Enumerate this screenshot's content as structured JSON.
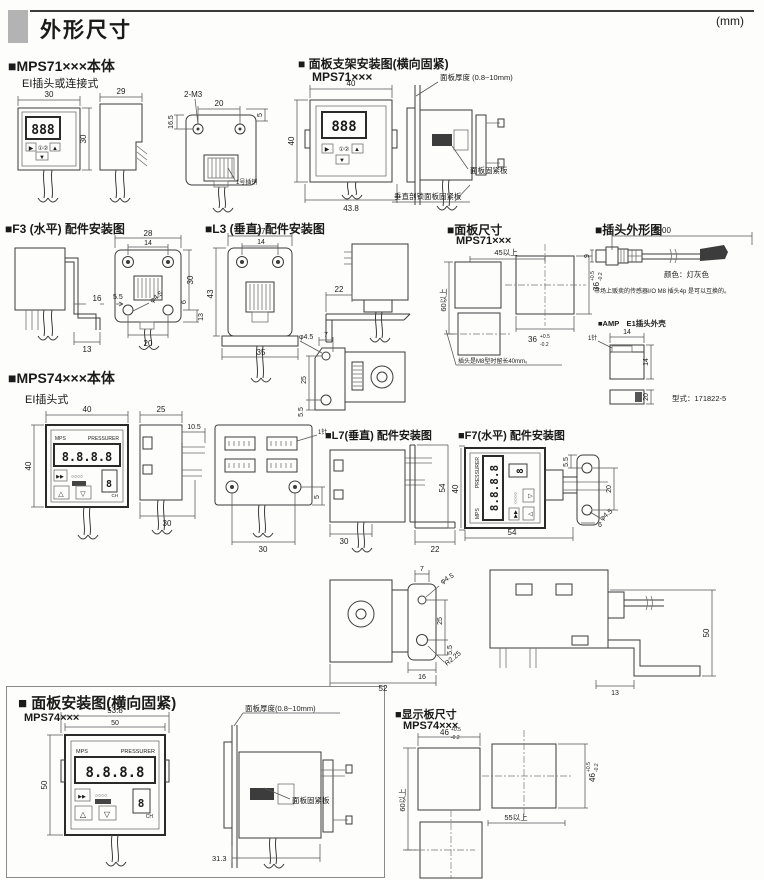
{
  "header": {
    "title": "外形尺寸",
    "unit": "(mm)"
  },
  "mps71": {
    "title": "■MPS71×××本体",
    "subtitle": "EI插头或连接式",
    "display": "888",
    "btn_right": "▶",
    "btn_up": "▲",
    "btn_down": "▼",
    "leds": "①②",
    "dim_front_w": "30",
    "dim_front_h": "30",
    "dim_side_w": "29",
    "screw": "2-M3",
    "dim_pitch": "20",
    "dim_h": "16.5",
    "dim_offset": "5",
    "pin_label": "1号插销"
  },
  "bracket71": {
    "title": "■ 面板支架安装图(横向固紧)",
    "model": "MPS71×××",
    "display": "888",
    "btn_right": "▶",
    "btn_up": "▲",
    "btn_down": "▼",
    "leds": "①②",
    "dim_w": "40",
    "dim_h": "40",
    "dim_bw": "43.8",
    "thickness": "面板厚度 (0.8~10mm)",
    "plate": "面板固紧板",
    "note": "垂直剖锁面板固紧板"
  },
  "f3": {
    "title": "■F3 (水平) 配件安装图",
    "d28": "28",
    "d14": "14",
    "d30": "30",
    "d16": "16",
    "d13a": "13",
    "d13b": "13",
    "d55": "5.5",
    "d20": "20",
    "d6": "6",
    "dphi": "φ4.5"
  },
  "l3": {
    "title": "■L3 (垂直) 配件安装图",
    "d27": "27",
    "d14": "14",
    "d43": "43",
    "d35": "35",
    "d22": "22",
    "d7": "7",
    "dphi": "φ4.5",
    "d25": "25",
    "d55": "5.5"
  },
  "panel71": {
    "title": "■面板尺寸",
    "model": "MPS71×××",
    "d45": "45以上",
    "d36": "36",
    "tol_p": "+0.5",
    "tol_m": "-0.2",
    "d60": "60以上",
    "note": "插头是M8型时留长40mm。"
  },
  "plug": {
    "title": "■插头外形图",
    "d2000": "2000",
    "d9": "9",
    "color": "颜色：灯灰色",
    "note": "市场上贩卖的传感器I/O M8 插头4p 是可以互换的。",
    "amp_title": "■AMP　E1插头外壳",
    "pin": "1针",
    "d14a": "14",
    "d14b": "14",
    "d20": "20",
    "model": "型式：171822-5"
  },
  "mps74": {
    "title": "■MPS74×××本体",
    "subtitle": "EI插头式",
    "brand": "MPS",
    "brand2": "PRESSURER",
    "display": "8.8.8.8",
    "ch_digit": "8",
    "ch": "CH",
    "btn_ff": "▶▶",
    "leds": "○○○○",
    "btn_up": "△",
    "btn_down": "▽",
    "dim_w": "40",
    "dim_h": "40",
    "dim_side": "25",
    "dim_tab": "10.5",
    "dim_side_b": "30",
    "pin": "1针",
    "dim_5": "5",
    "dim_back_b": "30"
  },
  "l7": {
    "title": "■L7(垂直) 配件安装图",
    "d30": "30",
    "d22": "22",
    "d54": "54"
  },
  "f7": {
    "title": "■F7(水平) 配件安装图",
    "brand": "MPS",
    "brand2": "PRESSURER",
    "display": "8.8.8.8",
    "ch_digit": "8",
    "btn_ff": "▶▶",
    "leds": "○○○○",
    "btn_up": "△",
    "btn_down": "▽",
    "d40": "40",
    "d54": "54",
    "d55": "5.5",
    "d20": "20",
    "dphi": "φ4.5",
    "d6": "6"
  },
  "lower": {
    "d7": "7",
    "dphi": "φ4.5",
    "d25": "25",
    "d55": "5.5",
    "d16": "16",
    "d52": "52",
    "dr": "R2.25",
    "d13": "13",
    "d50": "50"
  },
  "panel74": {
    "title": "■ 面板安装图(横向固紧)",
    "model": "MPS74×××",
    "brand": "MPS",
    "brand2": "PRESSURER",
    "display": "8.8.8.8",
    "ch_digit": "8",
    "ch": "CH",
    "btn_ff": "▶▶",
    "leds": "○○○○",
    "btn_up": "△",
    "btn_down": "▽",
    "d538": "53.8",
    "d50a": "50",
    "d50b": "50",
    "d313": "31.3",
    "thickness": "面板厚度(0.8~10mm)",
    "plate": "面板固紧板"
  },
  "display74": {
    "title": "■显示板尺寸",
    "model": "MPS74×××",
    "d46": "46",
    "tol_p": "+0.5",
    "tol_m": "-0.2",
    "d60": "60以上",
    "d55": "55以上"
  }
}
